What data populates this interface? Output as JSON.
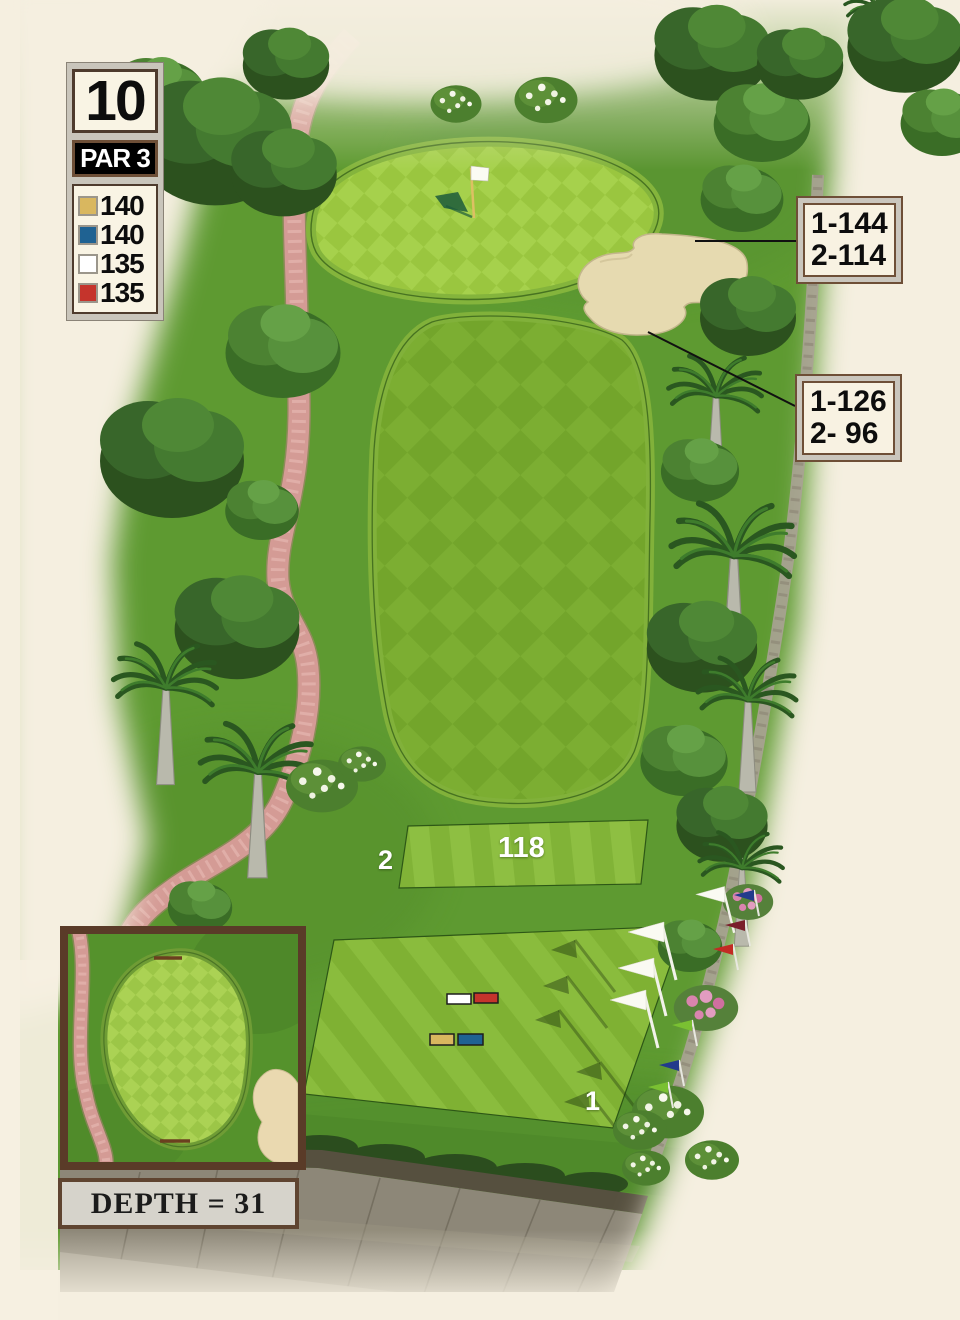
{
  "hole": {
    "number": "10",
    "par": "PAR 3"
  },
  "tees": [
    {
      "name": "gold",
      "color": "#d9b75f",
      "yardage": "140"
    },
    {
      "name": "blue",
      "color": "#1f6292",
      "yardage": "140"
    },
    {
      "name": "white",
      "color": "#ffffff",
      "yardage": "135"
    },
    {
      "name": "red",
      "color": "#c5342c",
      "yardage": "135"
    }
  ],
  "callouts": [
    {
      "line1": "1-144",
      "line2": "2-114"
    },
    {
      "line1": "1-126",
      "line2": "2- 96"
    }
  ],
  "tee_boxes": {
    "tee2_number": "2",
    "tee2_distance": "118",
    "tee1_number": "1"
  },
  "inset": {
    "depth_text": "DEPTH = 31"
  },
  "scene_colors": {
    "background_cream": "#f5efe0",
    "rough_green": "#5e9a31",
    "fairway_light": "#7cae32",
    "fairway_dark": "#73a52b",
    "putting_green_light": "#a6d14c",
    "putting_green_dark": "#9ac63f",
    "sand": "#e6dab0",
    "cart_path_pink": "#d49b95",
    "callout_line_black": "#111111"
  }
}
